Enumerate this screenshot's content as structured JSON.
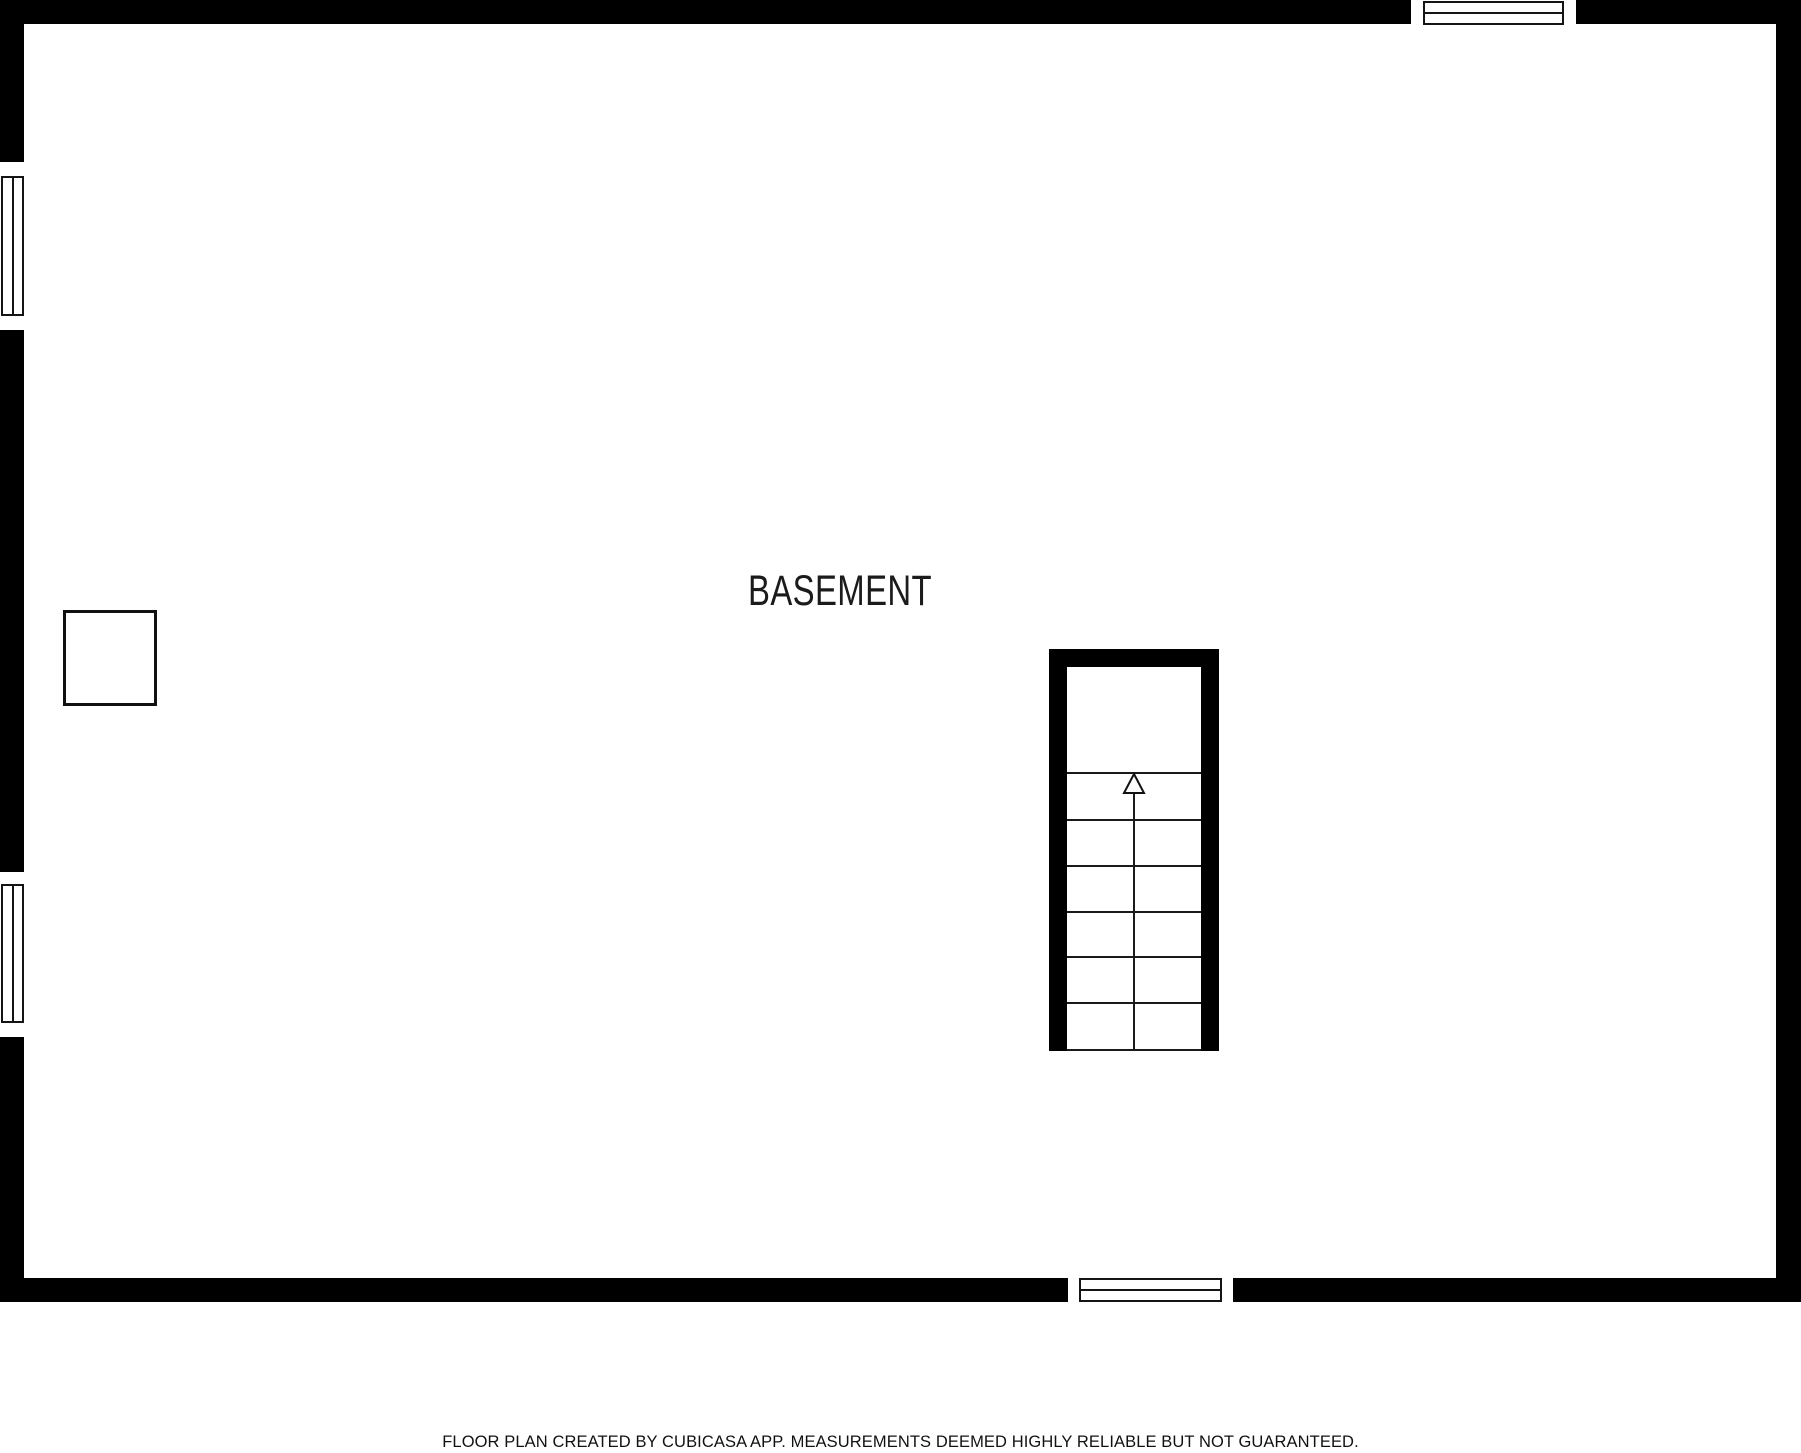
{
  "plan": {
    "room_label": "BASEMENT",
    "symbols": {
      "stair_arrow_icon": "up-arrow",
      "support_post": "square-post-outline",
      "window_count": 4
    }
  },
  "footer": {
    "note": "FLOOR PLAN CREATED BY CUBICASA APP. MEASUREMENTS DEEMED HIGHLY RELIABLE BUT NOT GUARANTEED."
  },
  "colors": {
    "wall": "#000000",
    "background": "#ffffff",
    "line": "#1a1a1a",
    "label_text": "#1b1b1b",
    "footer_text": "#111111"
  }
}
